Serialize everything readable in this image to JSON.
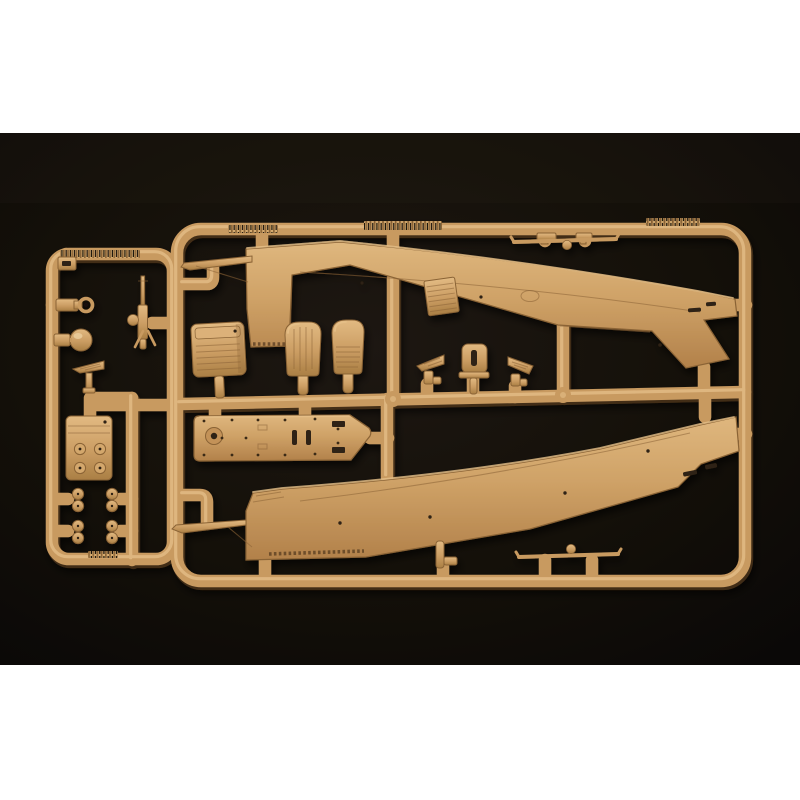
{
  "scene": {
    "type": "product-photograph",
    "description": "Sand-coloured injection-moulded plastic model kit sprue (parts tree) photographed on a black studio background, letterboxed on a white page",
    "subject": "Aircraft model sprue holding two large fuselage halves, cockpit seats, a floor panel, equipment boxes and many small detail parts",
    "molded_text": "illegible raised part-number lettering on the sprue rails"
  },
  "colors": {
    "page-bg": "#ffffff",
    "photo-bg": "#1a1410",
    "photo-bg-edge": "#0a0807",
    "plastic": "#c89a61",
    "plastic-light": "#e6c08a",
    "plastic-mid": "#b08343",
    "plastic-dark": "#8a6336",
    "plastic-deep": "#5c4123",
    "detail-dark": "#2e2012"
  },
  "parts": [
    {
      "id": "sprue-frame",
      "label": "Outer sprue frame rails"
    },
    {
      "id": "sprue-subframe",
      "label": "Left sub-frame with small parts"
    },
    {
      "id": "fuselage-upper",
      "label": "Fuselage half, upper position"
    },
    {
      "id": "fuselage-lower",
      "label": "Fuselage half, lower position"
    },
    {
      "id": "seat-front",
      "label": "Cockpit seat, front"
    },
    {
      "id": "seat-rear",
      "label": "Cockpit seat, rear"
    },
    {
      "id": "radio-box",
      "label": "Radio equipment box"
    },
    {
      "id": "cockpit-floor",
      "label": "Cockpit floor panel with rivets"
    },
    {
      "id": "louvered-panel",
      "label": "Louvred engine access panel"
    },
    {
      "id": "rudder-pedal-left",
      "label": "Rudder pedal wedge, left"
    },
    {
      "id": "rudder-pedal-right",
      "label": "Rudder pedal wedge, right"
    },
    {
      "id": "seat-frame",
      "label": "Small seat-back frame"
    },
    {
      "id": "machine-gun",
      "label": "Flexible machine gun"
    },
    {
      "id": "gun-ring",
      "label": "Ring sight bracket"
    },
    {
      "id": "wheel-dome",
      "label": "Wheel hub spinner dome"
    },
    {
      "id": "pitot-mast",
      "label": "Pitot mast with bracket"
    },
    {
      "id": "stowage-box",
      "label": "Stowage box with four filler caps"
    },
    {
      "id": "hub-caps",
      "label": "Four small twin-lobed hub parts"
    },
    {
      "id": "exhaust-upper",
      "label": "Exhaust stack, upper"
    },
    {
      "id": "exhaust-lower",
      "label": "Exhaust stack, lower"
    },
    {
      "id": "strut-upper",
      "label": "Support strut rod with ball joint, upper"
    },
    {
      "id": "strut-lower",
      "label": "Support strut rod with ball joint, lower"
    },
    {
      "id": "strut-brackets",
      "label": "Strut mounting brackets"
    },
    {
      "id": "text-ridge",
      "label": "Moulded lettering ridge (illegible)"
    }
  ]
}
